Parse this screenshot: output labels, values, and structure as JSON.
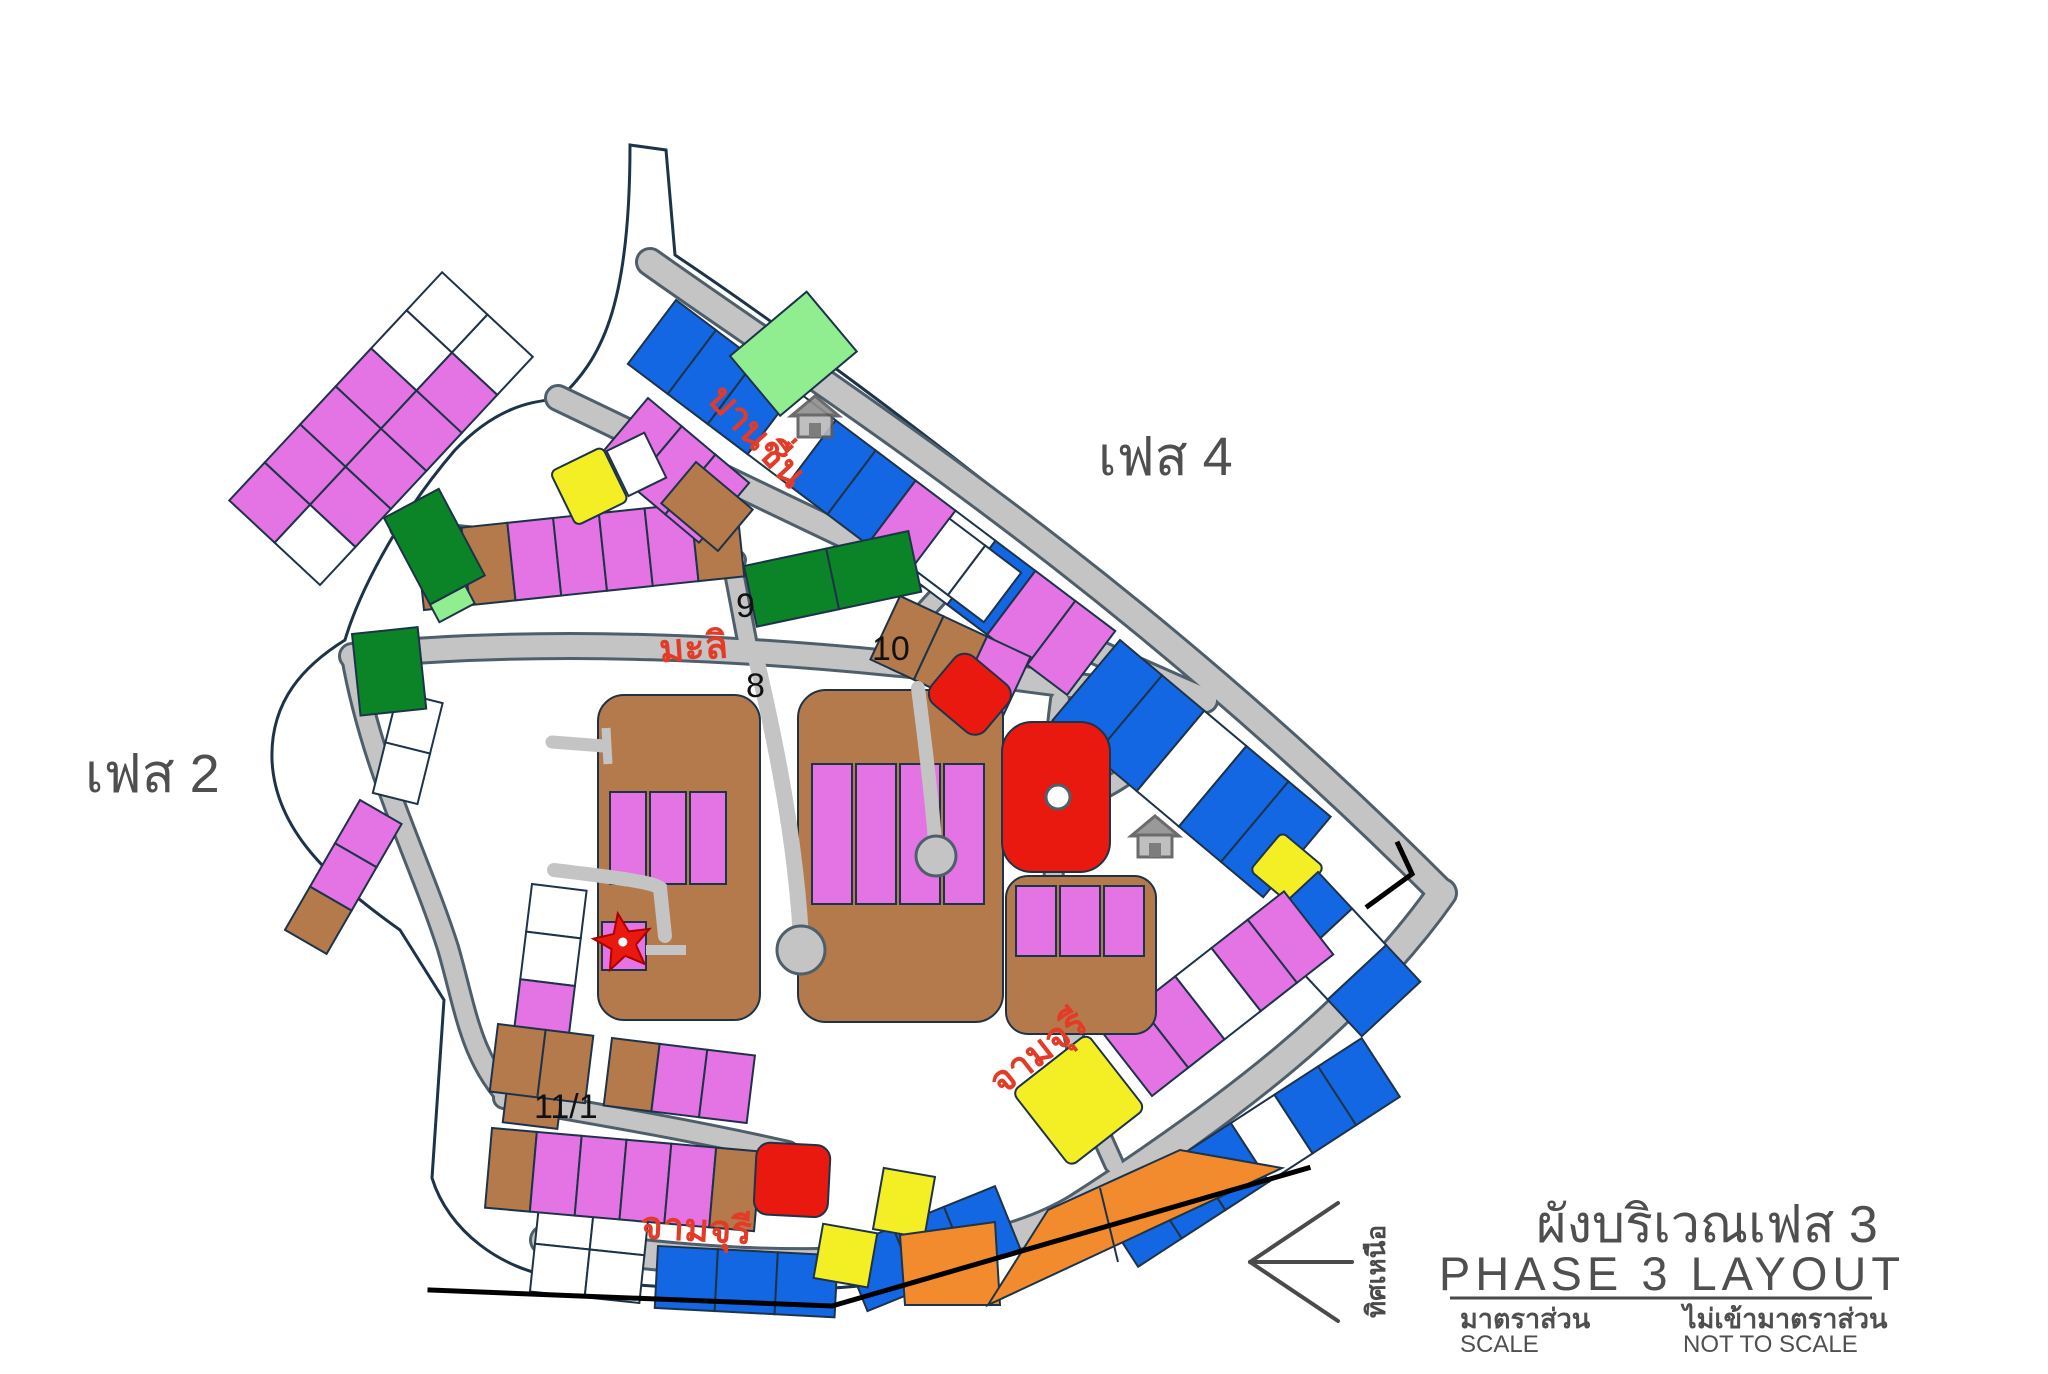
{
  "colors": {
    "site": "#8ef1f1",
    "road": "#c4c4c4",
    "road_casing": "#4e5f6b",
    "outline": "#1d3349",
    "lot_violet": "#e473e4",
    "lot_brown": "#b57a4b",
    "lot_blue": "#1467e2",
    "lot_white": "#ffffff",
    "lot_green_dark": "#0b8427",
    "lot_green_light": "#90ee90",
    "lot_yellow": "#f4ef25",
    "lot_orange": "#f18b2e",
    "lot_red": "#e9190f",
    "label_red": "#e23c28",
    "label_gray": "#4f4f4f",
    "label_black": "#111111"
  },
  "map": {
    "phase_label_right": "เฟส 4",
    "phase_label_left": "เฟส 2",
    "streets": {
      "banchuen": "บานชื่น",
      "mali": "มะลิ",
      "chamchuri_south": "จามจุรี",
      "chamchuri_east": "จามจุรี"
    },
    "junction_numbers": {
      "n9": "9",
      "n10": "10",
      "n8": "8",
      "n11_1": "11/1"
    },
    "marker": {
      "type": "red-star"
    }
  },
  "compass": {
    "north_label": "ทิศเหนือ",
    "direction": "left"
  },
  "title_block": {
    "title_thai": "ผังบริเวณเฟส 3",
    "title_english": "PHASE 3 LAYOUT",
    "scale_label_thai": "มาตราส่วน",
    "scale_label_english": "SCALE",
    "scale_value_thai": "ไม่เข้ามาตราส่วน",
    "scale_value_english": "NOT TO SCALE"
  }
}
